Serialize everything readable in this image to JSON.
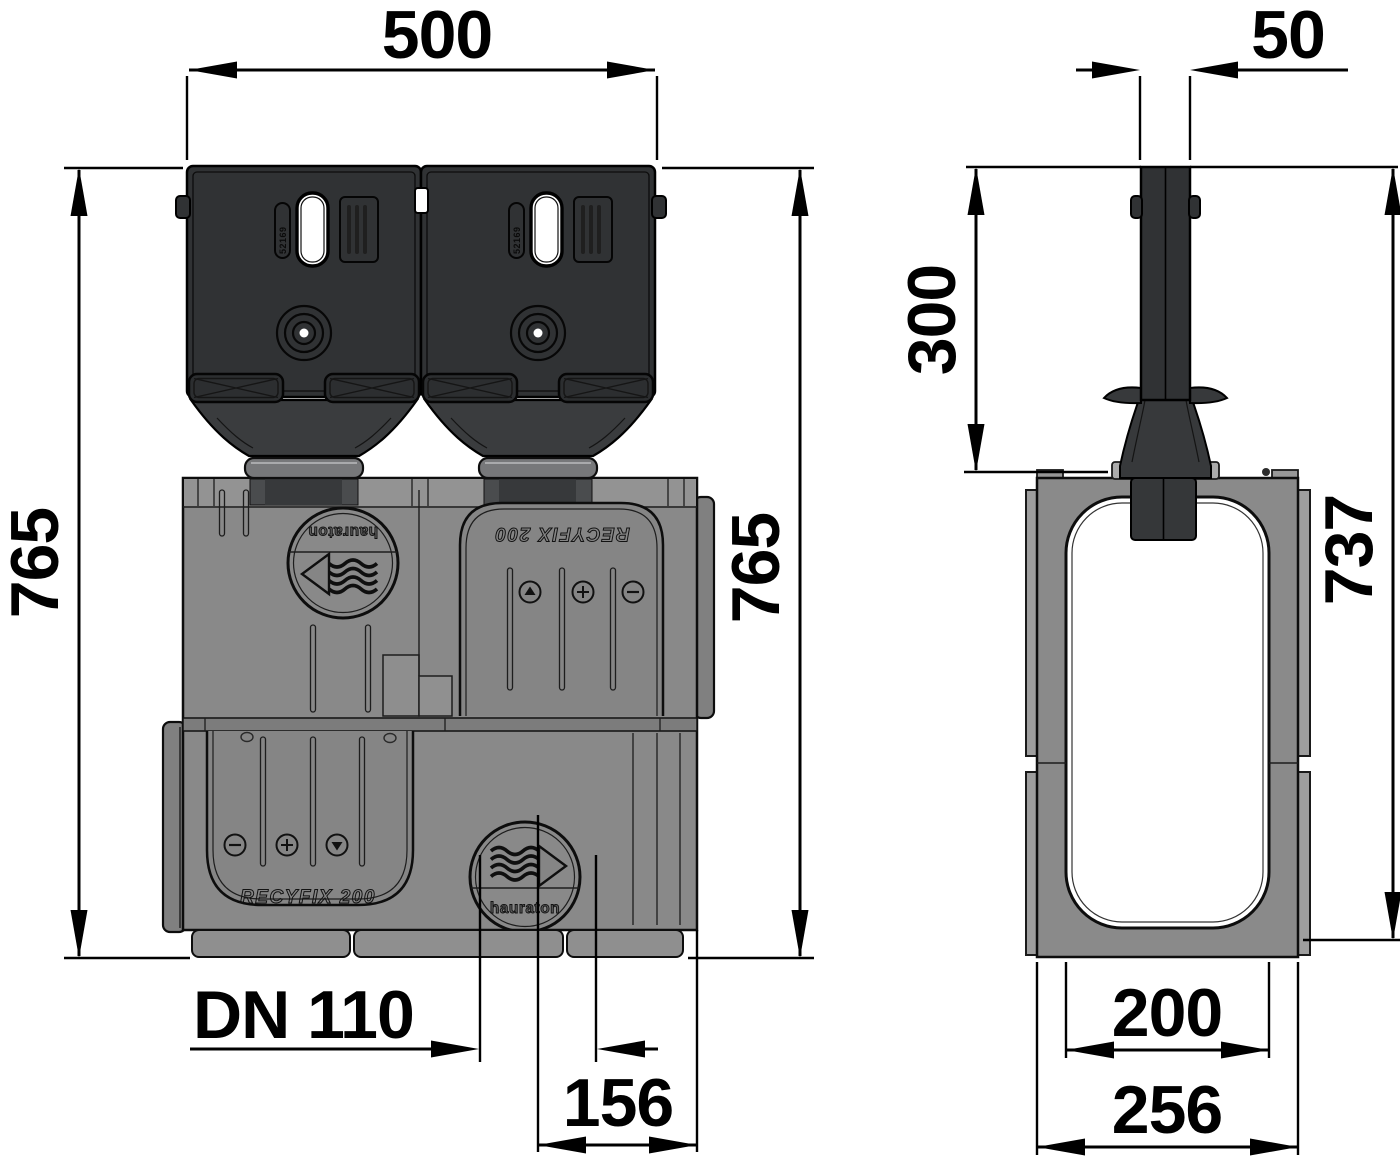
{
  "dimensions": {
    "front": {
      "overall_width": "500",
      "height_left": "765",
      "height_right": "765",
      "outlet_diameter": "DN 110",
      "outlet_offset": "156"
    },
    "side": {
      "slot_width": "50",
      "slot_height": "300",
      "channel_height": "737",
      "clear_width": "200",
      "overall_width": "256"
    }
  },
  "markings": {
    "brand": "hauraton",
    "product": "RECYFIX 200",
    "cast_code": "52169"
  }
}
